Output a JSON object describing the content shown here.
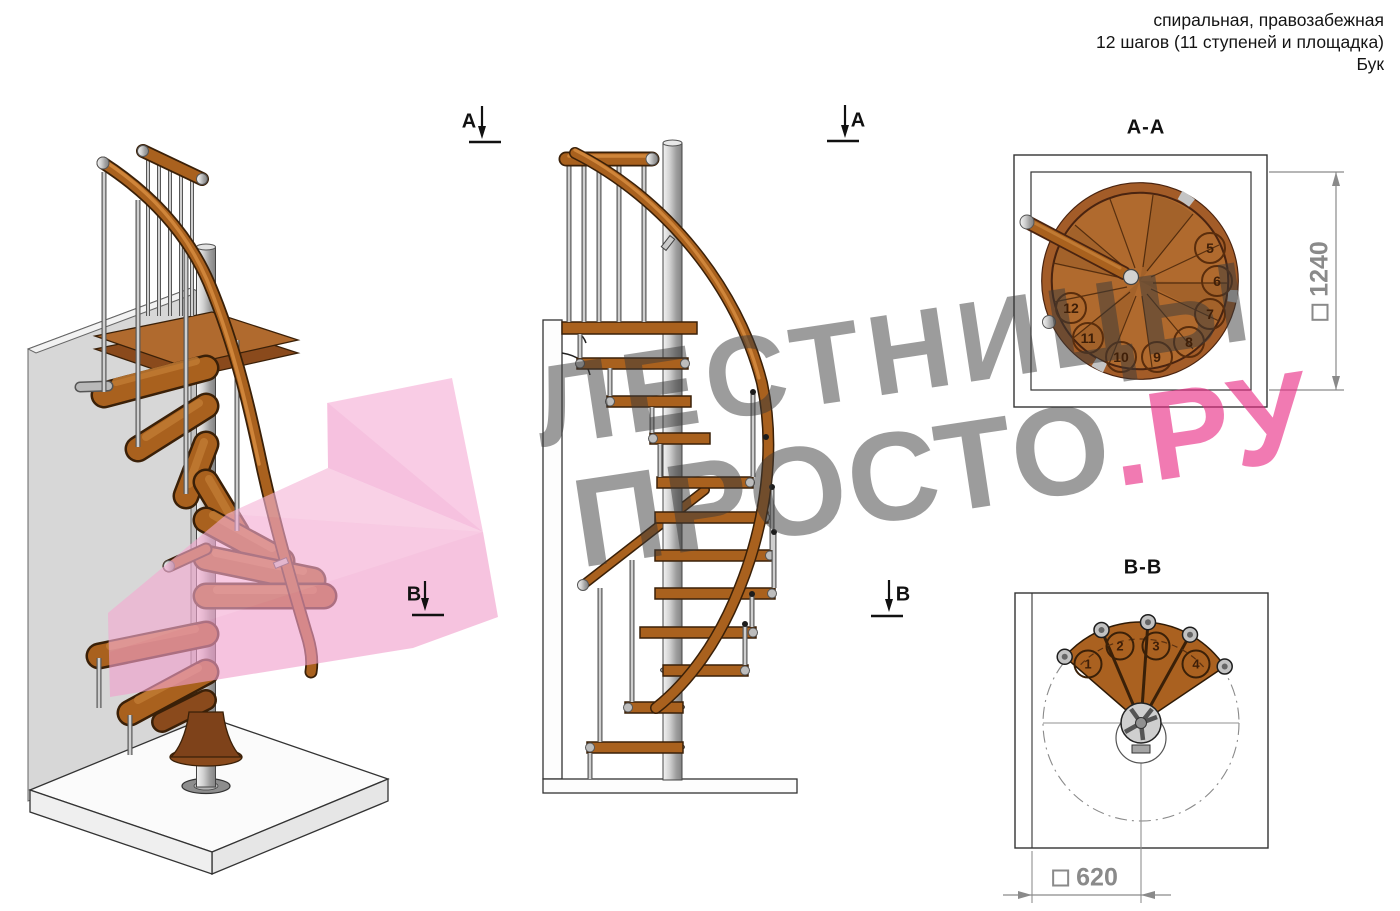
{
  "header": {
    "line1": "спиральная, правозабежная",
    "line2": "12 шагов (11 ступеней и площадка)",
    "line3": "Бук"
  },
  "watermark": {
    "line1": "ЛЕСТНИЦЫ",
    "line2_gray": "ПРОСТО",
    "line2_pink": ".РУ"
  },
  "markers": {
    "a_iso": "A",
    "b_iso": "B",
    "a_front": "A",
    "b_front": "B"
  },
  "section_aa": {
    "title": "A-A",
    "dimension": "1240",
    "square_symbol": "□",
    "steps": [
      "5",
      "6",
      "7",
      "8",
      "9",
      "10",
      "11",
      "12"
    ]
  },
  "section_bb": {
    "title": "B-B",
    "dimension": "620",
    "square_symbol": "□",
    "steps": [
      "1",
      "2",
      "3",
      "4"
    ]
  },
  "colors": {
    "wood": "#a9611e",
    "wood_dark": "#3a2008",
    "metal": "#c9c9c9",
    "wall_gray": "#d7d7d7",
    "watermark_gray": "#9a9a9a",
    "watermark_pink": "#ee72b2",
    "dimension_gray": "#8a8a8a"
  }
}
